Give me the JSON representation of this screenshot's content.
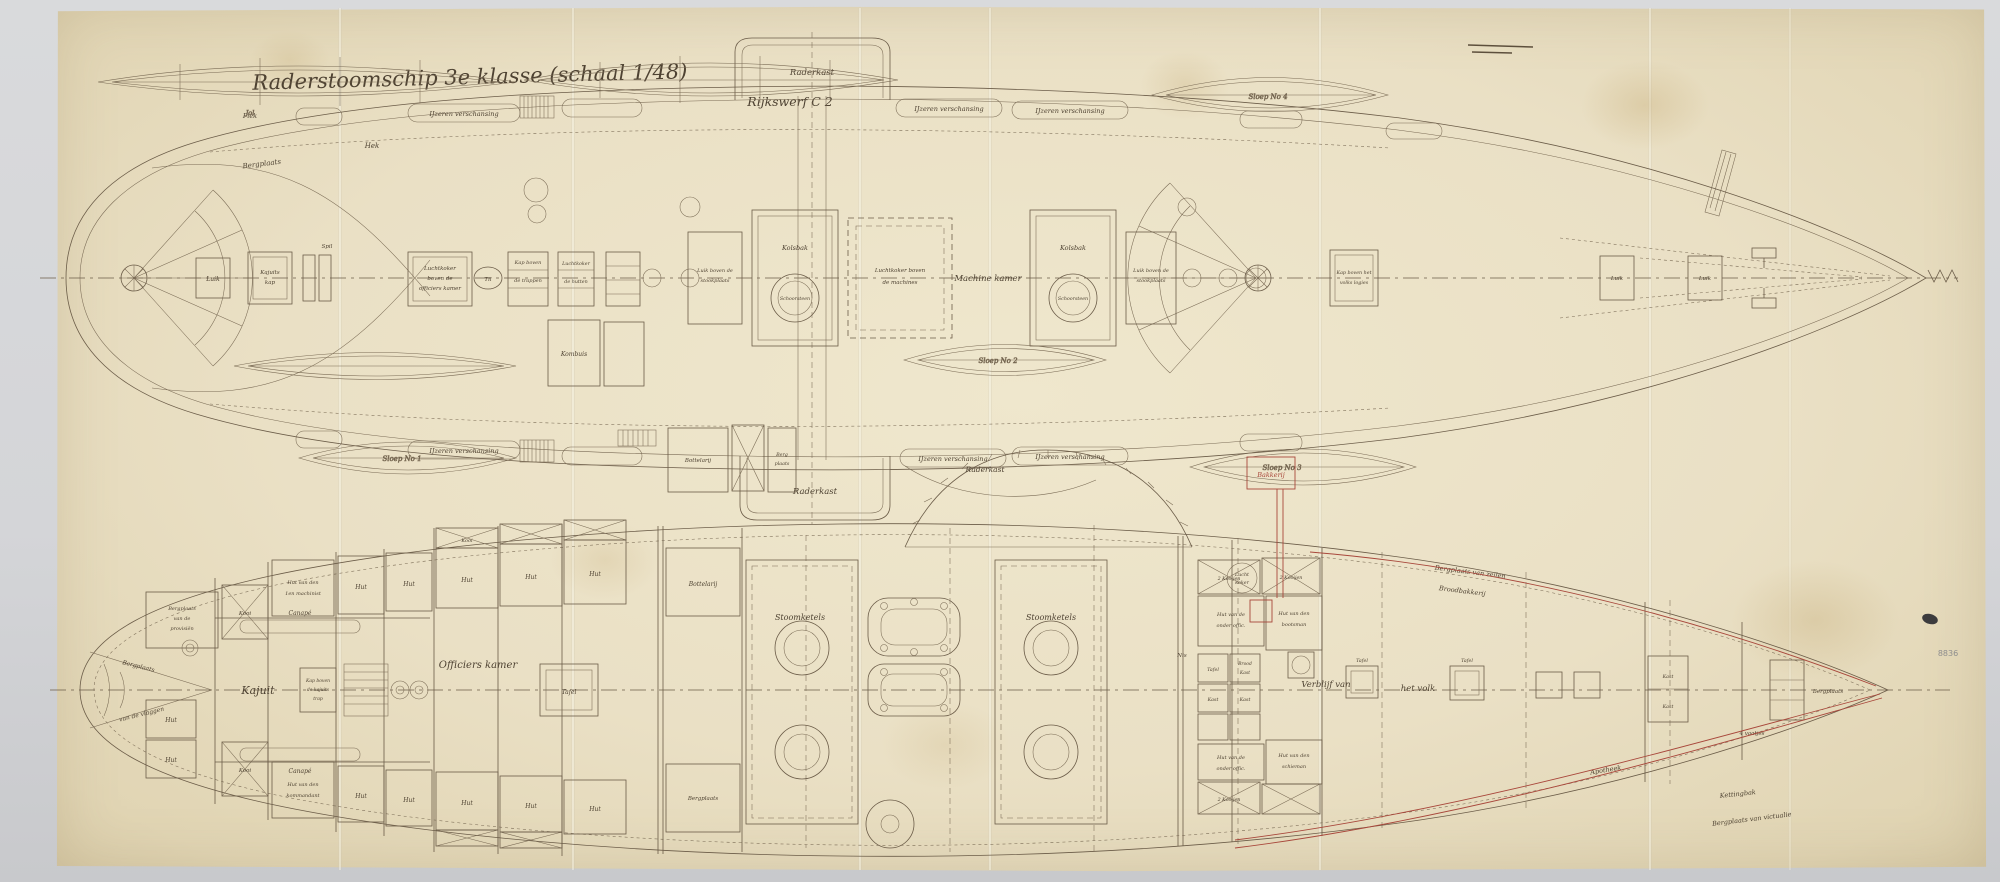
{
  "photo": {
    "background": "#d6d7d9",
    "paper": "#eae0c6",
    "ink": "#6b5c48",
    "text_ink": "#4e4232",
    "red_ink": "#a8473b",
    "pencil": "#8d8d8d"
  },
  "title": {
    "line1": "Raderstoomschip 3e klasse (schaal 1/48)",
    "line2": "Rijkswerf C 2"
  },
  "marks": {
    "bottom_right_pencil": "8836"
  },
  "boats": {
    "jol": "Jol",
    "sloep1": "Sloep No 1",
    "sloep2": "Sloep No 2",
    "sloep3": "Sloep No 3",
    "sloep4": "Sloep No 4"
  },
  "top_plan": {
    "labels": {
      "bergplaats": "Bergplaats",
      "hek": "Hek",
      "piek": "Piek",
      "rail": "IJzeren verschansing",
      "raderkast": "Raderkast",
      "luik": "Luik",
      "kajuits": "Kajuits",
      "kap": "kap",
      "luchtkoker": "Luchtkoker",
      "boven_de": "boven de",
      "officiers_kamer": "officiers kamer",
      "til": "Til",
      "kap_boven": "Kap boven",
      "de_trappen": "de trappen",
      "de_hutten": "de hutten",
      "luik_boven_de": "Luik boven de",
      "stookplaats": "stookplaats",
      "kolsbak": "Kolsbak",
      "schoorsteen": "Schoorsteen",
      "luchtkoker_boven": "Luchtkoker boven",
      "de_machines": "de machines",
      "machine_kamer": "Machine kamer",
      "kap_boven_het": "Kap boven het",
      "volks_logies": "volks logies",
      "spil": "Spil",
      "kombuis": "Kombuis",
      "bottelarij": "Bottelarij",
      "berg": "Berg",
      "plaats": "plaats"
    }
  },
  "bottom_plan": {
    "labels": {
      "vlaggen_1": "Bergplaats",
      "vlaggen_2": "van de vlaggen",
      "prov_1": "Bergplaats",
      "prov_2": "van de",
      "prov_3": "provisiën",
      "hut": "Hut",
      "kooi": "Kooi",
      "kooijen": "2 Kooijen",
      "machinist_1": "Hut van den",
      "machinist_2": "1en machinist",
      "kommandant_1": "Hut van den",
      "kommandant_2": "kommandant",
      "kajuit": "Kajuit",
      "canape": "Canapé",
      "kajuits_trap_1": "Kap boven",
      "kajuits_trap_2": "de kajuits",
      "kajuits_trap_3": "trap",
      "officiers_kamer": "Officiers kamer",
      "tafel": "Tafel",
      "bottelarij": "Bottelarij",
      "bergplaats": "Bergplaats",
      "stoomketels": "Stoomketels",
      "raderkast": "Raderkast",
      "lucht": "Lucht",
      "koker": "koker",
      "nis": "Nis",
      "brood": "Brood",
      "kast": "Kast",
      "onderoff_1": "Hut van de",
      "onderoff_2": "onder offic.",
      "bootsman_1": "Hut van den",
      "bootsman_2": "bootsman",
      "schieman_1": "Hut van den",
      "schieman_2": "schieman",
      "verblijf_1": "Verblijf van",
      "verblijf_2": "het volk",
      "vaatjes": "4 vaatjes",
      "zeilen": "Bergplaats van zeilen",
      "broodbakkerij": "Broodbakkerij",
      "kettingbak": "Kettingbak",
      "victualie": "Bergplaats van victualie",
      "apotheek": "Apotheek",
      "bakkerij": "Bakkerij"
    }
  }
}
